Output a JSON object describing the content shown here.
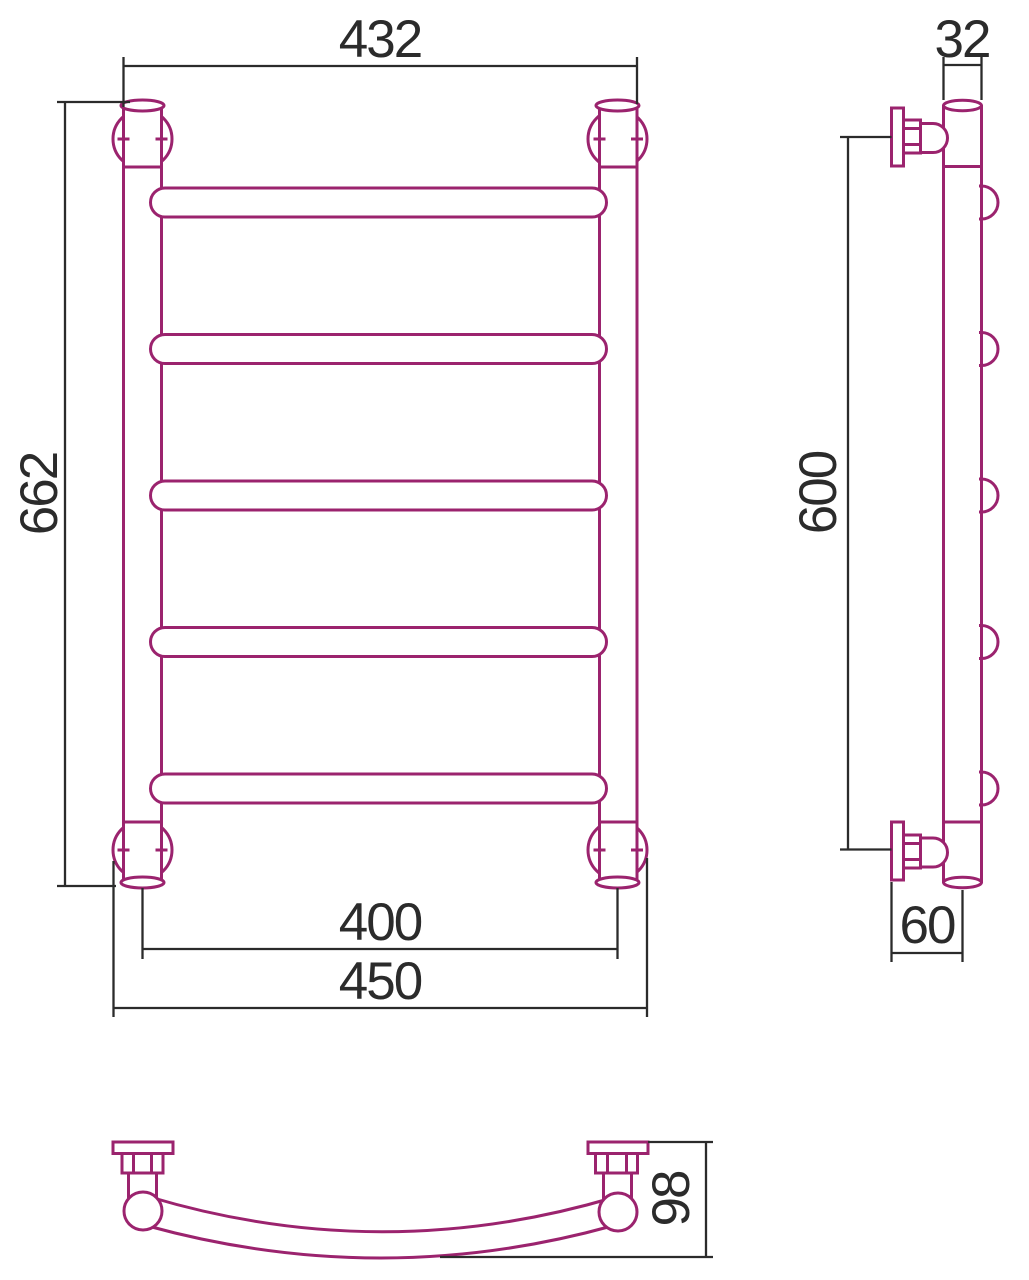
{
  "page": {
    "background": "#ffffff"
  },
  "colors": {
    "outline": "#9b236e",
    "dimension_lines": "#2b2b2b",
    "text": "#2b2b2b"
  },
  "dimensions": {
    "top_width": "432",
    "overall_height": "662",
    "axis_spacing_width": "400",
    "overall_width": "450",
    "pipe_width": "32",
    "bracket_spacing_height": "600",
    "wall_offset": "60",
    "depth": "98"
  },
  "front_view": {
    "rung_count": 5,
    "rung_x": 150.5,
    "rung_width": 456,
    "rung_height": 29,
    "rung_y_tops": [
      188,
      334.5,
      481,
      627.5,
      774
    ]
  },
  "side_view": {
    "bump_count": 5,
    "bump_centers_y": [
      202.5,
      349,
      495.5,
      642,
      788.5
    ]
  }
}
